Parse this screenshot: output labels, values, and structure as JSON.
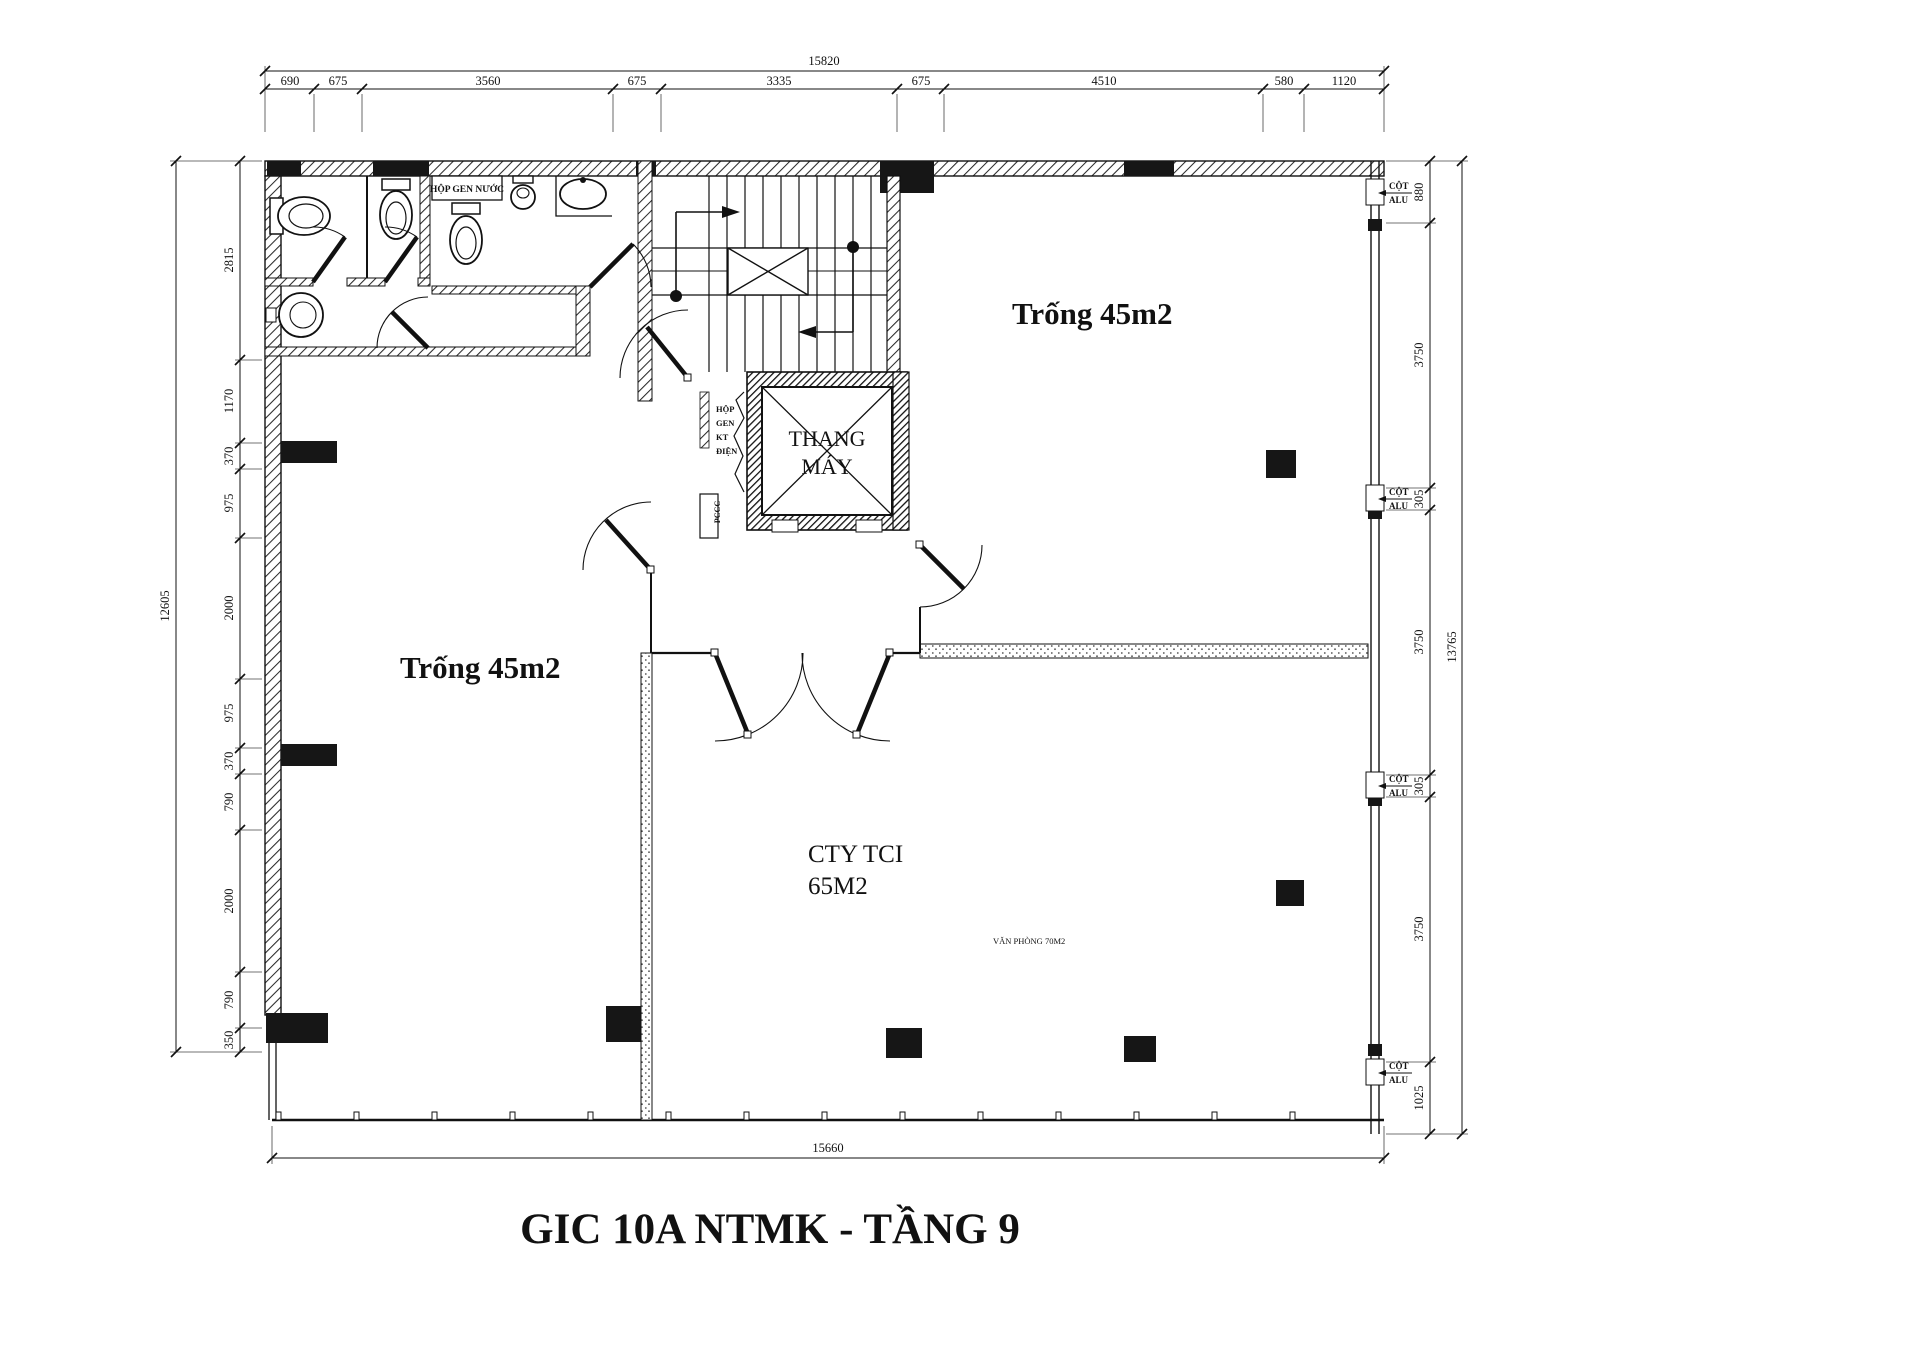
{
  "title": {
    "text": "GIC 10A NTMK - TẦNG 9"
  },
  "colors": {
    "red": "#ec1c22",
    "ink": "#1a1a1a",
    "muted": "#8a8a8a"
  },
  "rooms": {
    "left_room_label": "Trống 45m2",
    "right_room_label": "Trống 45m2",
    "office_name": "CTY TCI",
    "office_area": "65M2",
    "office_note": "VĂN PHÒNG 70M2",
    "elevator_line1": "THANG",
    "elevator_line2": "MÁY"
  },
  "plan_labels": {
    "water_riser_box": "HỘP GEN NƯỚC",
    "electrical_riser": {
      "l1": "HỘP",
      "l2": "GEN",
      "l3": "KT",
      "l4": "ĐIỆN"
    },
    "fire_box": "PCCC",
    "alu_column": {
      "l1": "CỘT",
      "l2": "ALU"
    }
  },
  "dims": {
    "top_total": "15820",
    "top_segments": [
      "690",
      "675",
      "3560",
      "675",
      "3335",
      "675",
      "4510",
      "580",
      "1120"
    ],
    "left_total": "12605",
    "left_segments": [
      "2815",
      "1170",
      "370",
      "975",
      "2000",
      "975",
      "370",
      "790",
      "2000",
      "790",
      "350"
    ],
    "right_total": "13765",
    "right_segments": [
      "880",
      "3750",
      "305",
      "3750",
      "305",
      "3750",
      "1025"
    ],
    "bottom_total": "15660"
  },
  "sidebar": {
    "location_title": "ĐỊA ĐIỂM:",
    "location_lines": [
      "10A NGUYỄN THỊ",
      "MINH KHAI, P ĐAKAO,",
      "QUẬN 1, TP HCM"
    ],
    "contractor_title": "ĐƠN VỊ THI CÔNG:",
    "category_title": "HẠNG MỤC:",
    "approval_title": "DUYỆT BẢN VẼ:"
  }
}
